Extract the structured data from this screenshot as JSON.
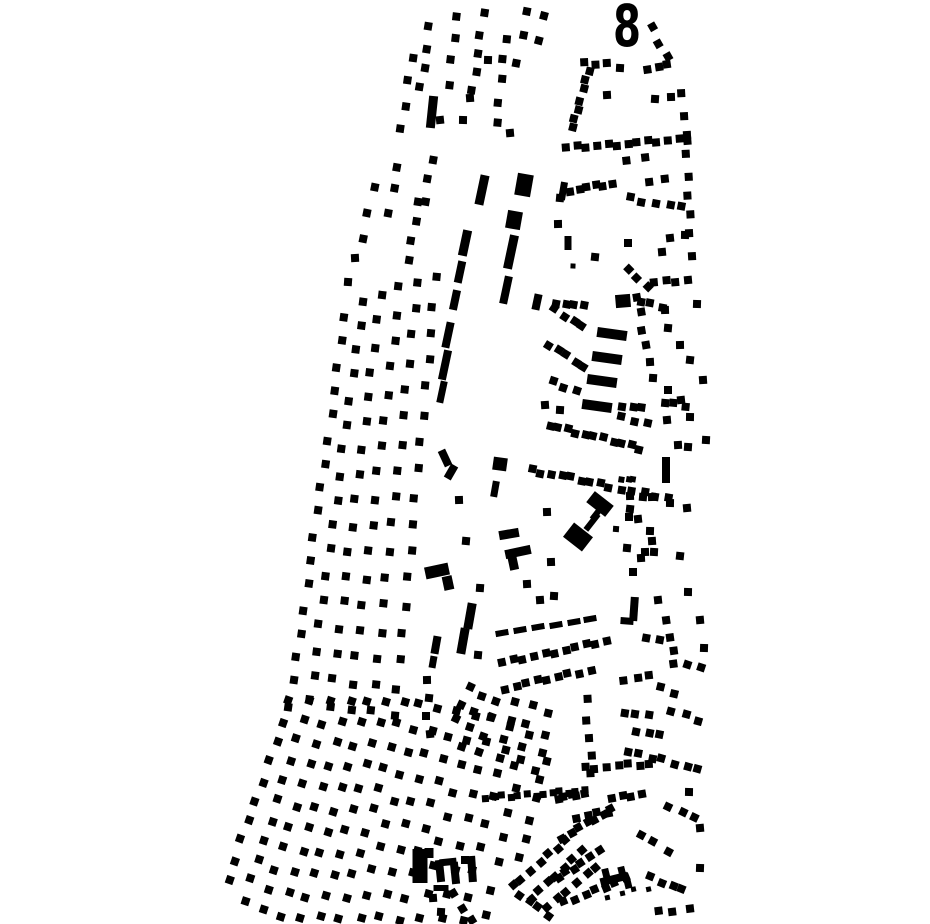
{
  "map": {
    "background": "#ffffff",
    "ink": "#000000",
    "label": {
      "text": "8",
      "x": 627,
      "y": 46,
      "size": 58
    },
    "rows": [
      [
        430,
        28,
        420,
        88,
        4
      ],
      [
        457,
        16,
        449,
        84,
        4
      ],
      [
        484,
        14,
        472,
        92,
        5
      ],
      [
        505,
        38,
        497,
        122,
        5
      ],
      [
        528,
        12,
        518,
        62,
        3
      ],
      [
        544,
        14,
        537,
        40,
        2
      ],
      [
        412,
        58,
        402,
        128,
        4
      ],
      [
        586,
        64,
        605,
        63,
        3
      ],
      [
        648,
        69,
        668,
        66,
        3
      ],
      [
        652,
        28,
        668,
        56,
        3
      ],
      [
        588,
        70,
        573,
        129,
        7
      ],
      [
        567,
        148,
        688,
        139,
        13
      ],
      [
        570,
        190,
        612,
        184,
        6
      ],
      [
        648,
        182,
        666,
        180,
        2
      ],
      [
        683,
        95,
        692,
        255,
        9
      ],
      [
        627,
        160,
        644,
        158,
        2
      ],
      [
        630,
        198,
        682,
        208,
        5
      ],
      [
        627,
        268,
        647,
        288,
        3
      ],
      [
        655,
        283,
        688,
        280,
        4
      ],
      [
        556,
        302,
        583,
        307,
        4
      ],
      [
        640,
        302,
        662,
        306,
        3
      ],
      [
        556,
        310,
        582,
        327,
        4
      ],
      [
        549,
        345,
        585,
        367,
        5
      ],
      [
        553,
        382,
        577,
        390,
        3
      ],
      [
        549,
        425,
        640,
        448,
        11
      ],
      [
        638,
        298,
        646,
        345,
        4
      ],
      [
        622,
        405,
        642,
        408,
        3
      ],
      [
        664,
        403,
        685,
        405,
        3
      ],
      [
        623,
        418,
        646,
        423,
        3
      ],
      [
        622,
        479,
        634,
        481,
        3,
        6
      ],
      [
        532,
        470,
        610,
        486,
        9
      ],
      [
        620,
        489,
        668,
        497,
        5
      ],
      [
        503,
        663,
        607,
        641,
        11
      ],
      [
        505,
        688,
        590,
        670,
        9
      ],
      [
        645,
        638,
        661,
        641,
        2
      ],
      [
        668,
        622,
        674,
        665,
        4
      ],
      [
        624,
        680,
        650,
        677,
        3
      ],
      [
        660,
        688,
        676,
        692,
        2
      ],
      [
        623,
        712,
        648,
        716,
        3
      ],
      [
        672,
        712,
        700,
        720,
        3
      ],
      [
        636,
        730,
        660,
        735,
        3
      ],
      [
        627,
        752,
        652,
        757,
        3
      ],
      [
        663,
        760,
        698,
        770,
        4
      ],
      [
        688,
        664,
        700,
        668,
        2
      ],
      [
        470,
        688,
        456,
        718,
        3
      ],
      [
        480,
        695,
        463,
        745,
        4
      ],
      [
        497,
        702,
        479,
        752,
        4
      ],
      [
        515,
        700,
        499,
        760,
        4
      ],
      [
        532,
        705,
        516,
        765,
        4
      ],
      [
        550,
        715,
        536,
        772,
        4
      ],
      [
        486,
        798,
        585,
        791,
        13,
        7
      ],
      [
        587,
        700,
        591,
        775,
        5
      ],
      [
        545,
        760,
        521,
        858,
        6
      ],
      [
        345,
        318,
        290,
        706,
        17
      ],
      [
        363,
        300,
        310,
        700,
        17
      ],
      [
        381,
        295,
        330,
        705,
        17
      ],
      [
        400,
        288,
        350,
        710,
        17
      ],
      [
        418,
        282,
        372,
        712,
        17
      ],
      [
        436,
        278,
        395,
        715,
        17
      ],
      [
        373,
        186,
        362,
        240,
        3
      ],
      [
        398,
        168,
        390,
        212,
        3
      ],
      [
        418,
        200,
        408,
        262,
        4
      ],
      [
        432,
        160,
        425,
        200,
        3
      ],
      [
        290,
        702,
        228,
        880,
        10
      ],
      [
        310,
        700,
        245,
        900,
        11
      ],
      [
        330,
        702,
        262,
        910,
        11
      ],
      [
        350,
        700,
        282,
        915,
        11
      ],
      [
        368,
        702,
        300,
        918,
        11
      ],
      [
        386,
        700,
        320,
        918,
        11
      ],
      [
        404,
        702,
        340,
        918,
        11
      ],
      [
        420,
        705,
        360,
        918,
        10
      ],
      [
        438,
        708,
        380,
        918,
        10
      ],
      [
        456,
        712,
        400,
        920,
        10
      ],
      [
        474,
        715,
        420,
        918,
        9
      ],
      [
        492,
        718,
        442,
        920,
        9
      ],
      [
        510,
        725,
        462,
        920,
        9
      ],
      [
        528,
        735,
        485,
        915,
        8
      ],
      [
        455,
        895,
        470,
        920,
        3
      ],
      [
        520,
        895,
        548,
        915,
        4
      ],
      [
        513,
        886,
        566,
        840,
        7
      ],
      [
        530,
        898,
        582,
        852,
        7
      ],
      [
        548,
        908,
        596,
        866,
        6
      ],
      [
        562,
        837,
        612,
        810,
        7
      ],
      [
        558,
        878,
        598,
        852,
        6
      ],
      [
        565,
        903,
        625,
        878,
        7
      ],
      [
        577,
        818,
        608,
        812,
        4
      ],
      [
        585,
        768,
        650,
        764,
        7
      ],
      [
        557,
        798,
        584,
        793,
        5
      ],
      [
        613,
        799,
        642,
        794,
        4
      ],
      [
        668,
        805,
        695,
        818,
        3
      ],
      [
        640,
        835,
        668,
        850,
        3
      ],
      [
        652,
        878,
        682,
        890,
        4
      ],
      [
        608,
        897,
        648,
        888,
        4,
        5
      ],
      [
        658,
        912,
        690,
        908,
        3
      ]
    ],
    "bars": [
      [
        432,
        112,
        9,
        32,
        6
      ],
      [
        482,
        190,
        9,
        30,
        12
      ],
      [
        465,
        243,
        9,
        26,
        12
      ],
      [
        460,
        272,
        8,
        22,
        12
      ],
      [
        455,
        300,
        8,
        20,
        12
      ],
      [
        448,
        335,
        8,
        26,
        12
      ],
      [
        445,
        365,
        8,
        30,
        12
      ],
      [
        442,
        392,
        7,
        22,
        12
      ],
      [
        511,
        252,
        9,
        34,
        12
      ],
      [
        506,
        290,
        8,
        28,
        12
      ],
      [
        537,
        302,
        8,
        16,
        12
      ],
      [
        524,
        185,
        16,
        22,
        10
      ],
      [
        514,
        220,
        15,
        18,
        10
      ],
      [
        563,
        191,
        7,
        18,
        10
      ],
      [
        568,
        243,
        7,
        14,
        0
      ],
      [
        623,
        301,
        15,
        13,
        -5
      ],
      [
        612,
        334,
        30,
        10,
        8
      ],
      [
        607,
        358,
        30,
        10,
        8
      ],
      [
        602,
        381,
        30,
        10,
        8
      ],
      [
        597,
        406,
        30,
        10,
        8
      ],
      [
        666,
        470,
        8,
        26,
        0
      ],
      [
        500,
        464,
        14,
        13,
        8
      ],
      [
        495,
        489,
        7,
        16,
        10
      ],
      [
        470,
        616,
        9,
        26,
        10
      ],
      [
        463,
        641,
        9,
        26,
        10
      ],
      [
        436,
        645,
        8,
        18,
        10
      ],
      [
        433,
        662,
        7,
        12,
        10
      ],
      [
        502,
        633,
        13,
        6,
        -10
      ],
      [
        520,
        630,
        13,
        6,
        -10
      ],
      [
        538,
        627,
        13,
        6,
        -10
      ],
      [
        556,
        625,
        13,
        6,
        -10
      ],
      [
        574,
        622,
        13,
        6,
        -10
      ],
      [
        590,
        619,
        13,
        6,
        -10
      ],
      [
        518,
        552,
        26,
        9,
        -12
      ],
      [
        513,
        562,
        9,
        16,
        -12
      ],
      [
        509,
        534,
        20,
        9,
        -10
      ],
      [
        437,
        571,
        24,
        12,
        -12
      ],
      [
        448,
        583,
        10,
        14,
        -12
      ],
      [
        445,
        458,
        8,
        17,
        -25
      ],
      [
        451,
        472,
        8,
        15,
        30
      ],
      [
        600,
        504,
        24,
        14,
        38
      ],
      [
        578,
        537,
        24,
        18,
        38
      ],
      [
        592,
        522,
        20,
        6,
        -52
      ],
      [
        597,
        513,
        16,
        6,
        -52
      ],
      [
        420,
        866,
        15,
        34,
        0
      ],
      [
        429,
        853,
        9,
        10,
        0
      ],
      [
        440,
        871,
        8,
        22,
        -6
      ],
      [
        455,
        873,
        8,
        22,
        -6
      ],
      [
        448,
        862,
        17,
        7,
        -6
      ],
      [
        441,
        888,
        15,
        6,
        0
      ],
      [
        472,
        869,
        8,
        26,
        -4
      ],
      [
        465,
        860,
        8,
        8,
        0
      ],
      [
        634,
        609,
        8,
        24,
        4
      ],
      [
        627,
        621,
        13,
        7,
        4
      ],
      [
        614,
        879,
        28,
        8,
        -14
      ],
      [
        606,
        874,
        7,
        11,
        -14
      ],
      [
        622,
        872,
        7,
        11,
        -14
      ],
      [
        628,
        884,
        7,
        9,
        -14
      ]
    ],
    "dots": [
      [
        440,
        120
      ],
      [
        463,
        120
      ],
      [
        510,
        133
      ],
      [
        488,
        60
      ],
      [
        470,
        98
      ],
      [
        620,
        68
      ],
      [
        607,
        95
      ],
      [
        655,
        99
      ],
      [
        671,
        97
      ],
      [
        560,
        198
      ],
      [
        558,
        224
      ],
      [
        595,
        257
      ],
      [
        628,
        243
      ],
      [
        670,
        238
      ],
      [
        685,
        235
      ],
      [
        662,
        252
      ],
      [
        573,
        266,
        5
      ],
      [
        545,
        405
      ],
      [
        560,
        410
      ],
      [
        650,
        362
      ],
      [
        653,
        378
      ],
      [
        665,
        310
      ],
      [
        668,
        328
      ],
      [
        680,
        345
      ],
      [
        690,
        360
      ],
      [
        668,
        390
      ],
      [
        681,
        400
      ],
      [
        690,
        417
      ],
      [
        667,
        420
      ],
      [
        697,
        304
      ],
      [
        703,
        380
      ],
      [
        706,
        440
      ],
      [
        678,
        445
      ],
      [
        688,
        447
      ],
      [
        630,
        496
      ],
      [
        643,
        497
      ],
      [
        652,
        497
      ],
      [
        630,
        509
      ],
      [
        629,
        517
      ],
      [
        638,
        519
      ],
      [
        670,
        503
      ],
      [
        687,
        508
      ],
      [
        650,
        531
      ],
      [
        652,
        541
      ],
      [
        654,
        552
      ],
      [
        641,
        558
      ],
      [
        616,
        529,
        6
      ],
      [
        547,
        512
      ],
      [
        627,
        548
      ],
      [
        645,
        552
      ],
      [
        680,
        556
      ],
      [
        633,
        572
      ],
      [
        658,
        600
      ],
      [
        688,
        592
      ],
      [
        700,
        620
      ],
      [
        704,
        648
      ],
      [
        540,
        600
      ],
      [
        554,
        596
      ],
      [
        527,
        584
      ],
      [
        480,
        588
      ],
      [
        551,
        562
      ],
      [
        478,
        655
      ],
      [
        427,
        680
      ],
      [
        429,
        698
      ],
      [
        426,
        716
      ],
      [
        430,
        734
      ],
      [
        689,
        792
      ],
      [
        700,
        828
      ],
      [
        700,
        868
      ],
      [
        433,
        898
      ],
      [
        441,
        912
      ],
      [
        355,
        258
      ],
      [
        348,
        282
      ],
      [
        459,
        500
      ],
      [
        466,
        541
      ]
    ]
  }
}
